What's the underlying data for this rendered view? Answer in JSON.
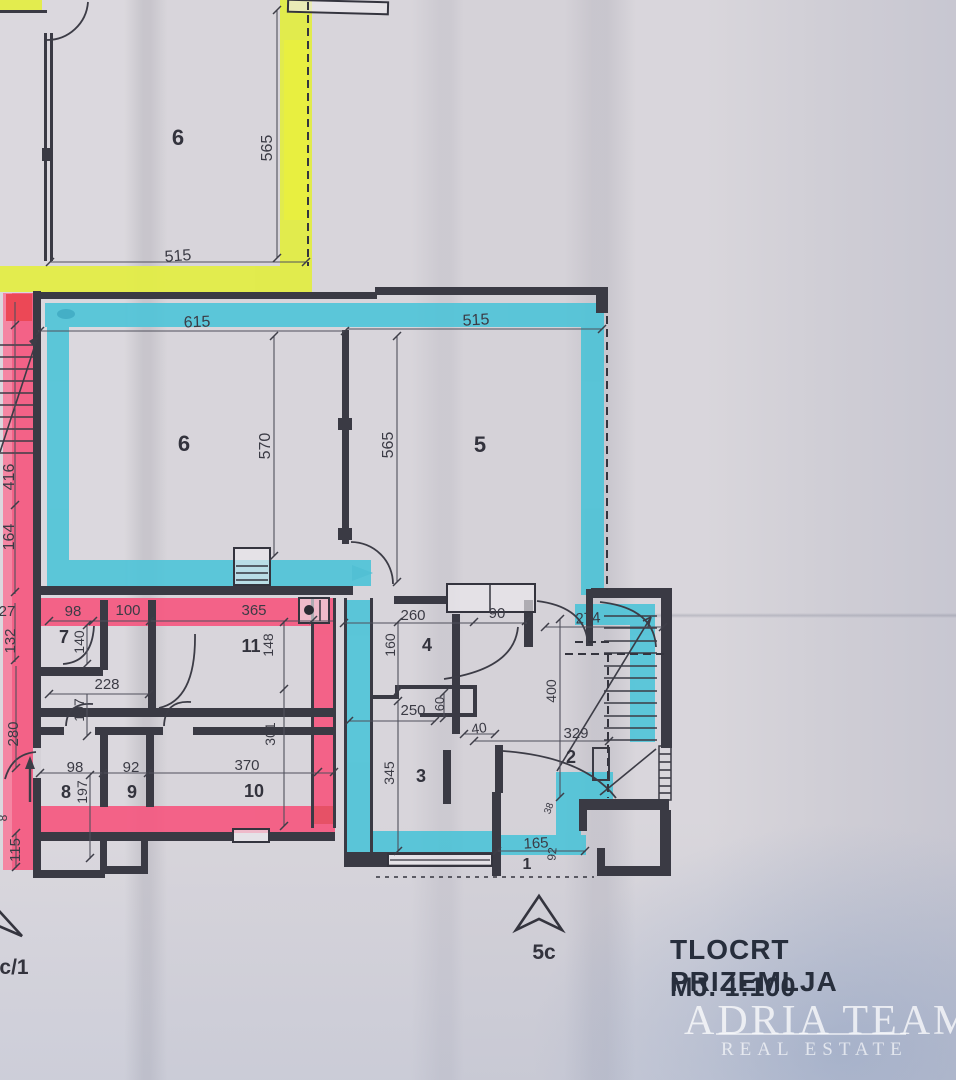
{
  "document": {
    "kind": "floor-plan-photo"
  },
  "title_block": {
    "line1": "TLOCRT PRIZEMLJA",
    "line2": "MJ. 1:100"
  },
  "watermark": {
    "line1": "ADRIA TEAM",
    "line2": "REAL ESTATE"
  },
  "colors": {
    "highlight_yellow": "#e3ee3e",
    "highlight_cyan": "#45c3d8",
    "highlight_pink": "#f84e79",
    "ink": "#3a3a44",
    "title_ink": "#272e3c"
  },
  "labels": {
    "t565": "565",
    "t515": "515",
    "room6_top": "6",
    "m615": "615",
    "m515": "515",
    "m570": "570",
    "m565": "565",
    "room6": "6",
    "room5": "5",
    "l416": "416",
    "l164": "164",
    "l27": "27",
    "l132": "132",
    "l280": "280",
    "l115": "115",
    "l8": "8",
    "p98": "98",
    "p100": "100",
    "p365": "365",
    "room7": "7",
    "d140": "140",
    "room11": "11",
    "d148": "148",
    "d228": "228",
    "d107": "107",
    "b98": "98",
    "b92": "92",
    "b370": "370",
    "room8": "8",
    "room9": "9",
    "room10": "10",
    "d197": "197",
    "d301": "301",
    "d260": "260",
    "d90": "90",
    "room4": "4",
    "d160": "160",
    "d274": "274",
    "d400": "400",
    "d250": "250",
    "d60": "60",
    "d40": "40",
    "d329": "329",
    "room2": "2",
    "room3": "3",
    "d345": "345",
    "d38": "38",
    "d165": "165",
    "room1": "1",
    "d92v": "92",
    "marker_5c": "5c",
    "marker_c1": "c/1"
  }
}
